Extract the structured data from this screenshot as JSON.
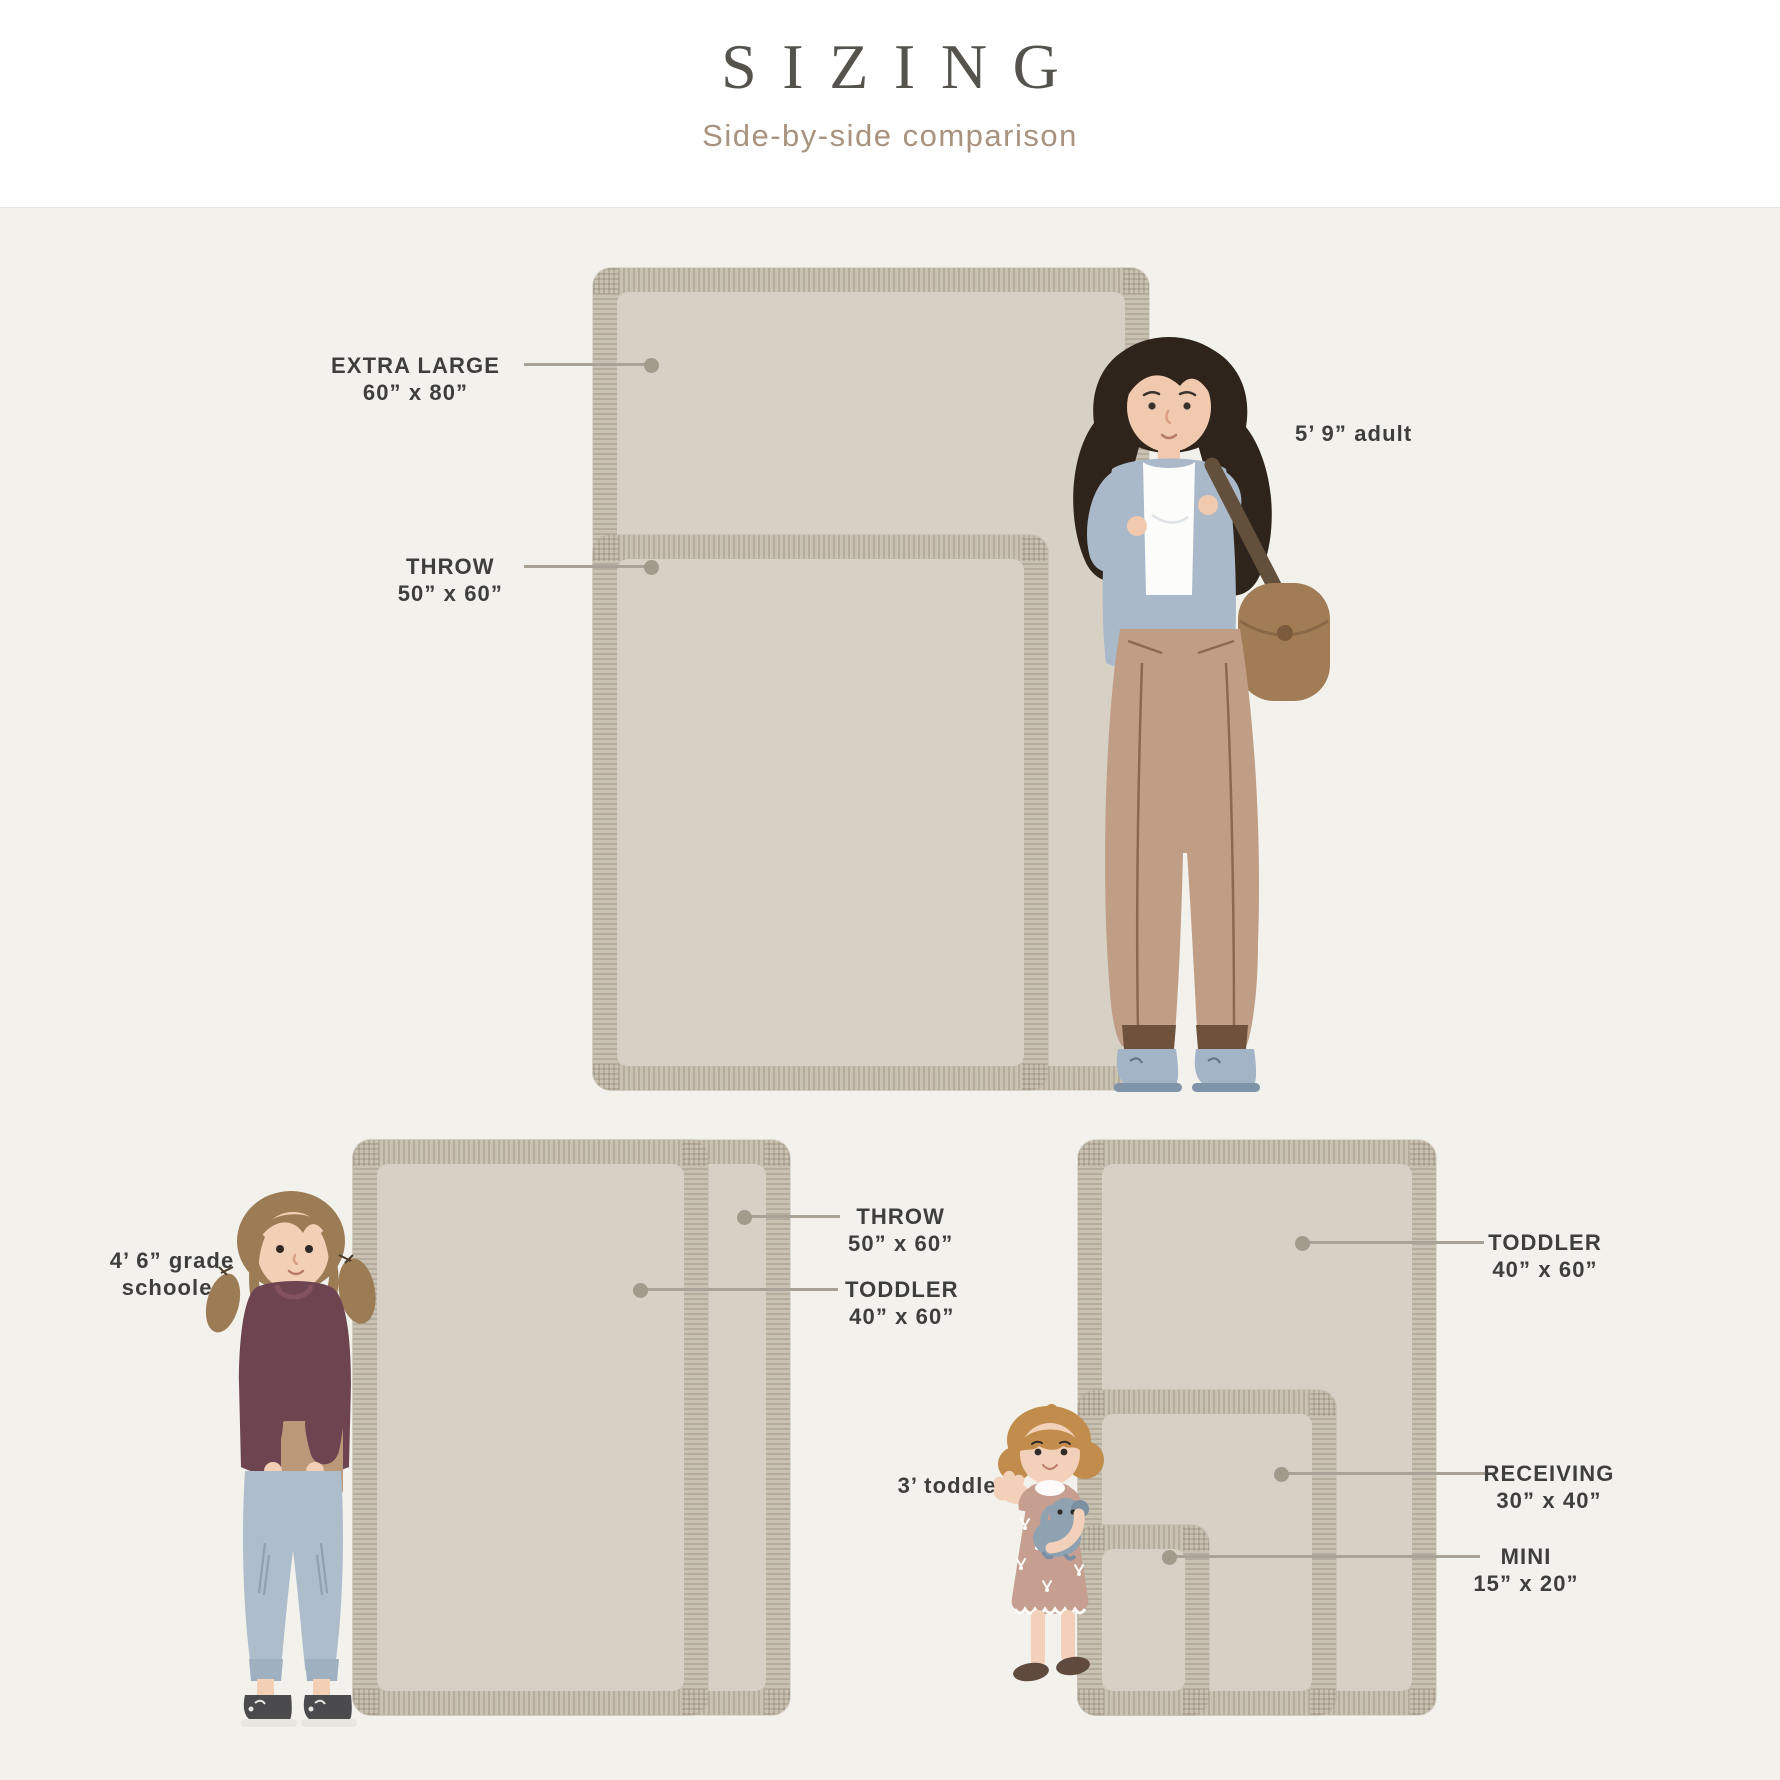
{
  "header": {
    "title": "SIZING",
    "subtitle": "Side-by-side comparison"
  },
  "palette": {
    "background": "#f2f1ec",
    "header_background": "#ffffff",
    "blanket_fringe": "#c9c1b2",
    "blanket_surface": "#d6d0c5",
    "leader_line": "#a9a296",
    "leader_dot": "#a29b8c",
    "label_text": "#3e3e3b",
    "title_text": "#55534e",
    "subtitle_text": "#a8937e"
  },
  "diagram": {
    "canvas": {
      "width": 1780,
      "height": 1780
    },
    "blankets": [
      {
        "id": "extra-large-top",
        "label": "EXTRA LARGE",
        "dimensions": "60” x 80”",
        "rect": {
          "x": 593,
          "y": 268,
          "w": 556,
          "h": 822
        }
      },
      {
        "id": "throw-top",
        "label": "THROW",
        "dimensions": "50” x 60”",
        "rect": {
          "x": 593,
          "y": 535,
          "w": 455,
          "h": 555
        }
      },
      {
        "id": "throw-bottom-left",
        "label": "THROW",
        "dimensions": "50” x 60”",
        "rect": {
          "x": 353,
          "y": 1140,
          "w": 437,
          "h": 575
        }
      },
      {
        "id": "toddler-bottom-left",
        "label": "TODDLER",
        "dimensions": "40” x 60”",
        "rect": {
          "x": 353,
          "y": 1140,
          "w": 355,
          "h": 575
        }
      },
      {
        "id": "toddler-bottom-right",
        "label": "TODDLER",
        "dimensions": "40” x 60”",
        "rect": {
          "x": 1078,
          "y": 1140,
          "w": 358,
          "h": 575
        }
      },
      {
        "id": "receiving",
        "label": "RECEIVING",
        "dimensions": "30” x 40”",
        "rect": {
          "x": 1078,
          "y": 1390,
          "w": 258,
          "h": 325
        }
      },
      {
        "id": "mini",
        "label": "MINI",
        "dimensions": "15” x 20”",
        "rect": {
          "x": 1078,
          "y": 1525,
          "w": 131,
          "h": 190
        }
      }
    ],
    "callouts": [
      {
        "id": "extra-large",
        "lines": [
          "EXTRA LARGE",
          "60” x 80”"
        ],
        "anchor": "right",
        "x": 500,
        "y": 352,
        "line": {
          "x1": 524,
          "x2": 651,
          "y": 364
        },
        "dot": {
          "x": 651,
          "y": 365
        }
      },
      {
        "id": "throw-top",
        "lines": [
          "THROW",
          "50” x 60”"
        ],
        "anchor": "right",
        "x": 503,
        "y": 553,
        "line": {
          "x1": 524,
          "x2": 651,
          "y": 566
        },
        "dot": {
          "x": 651,
          "y": 567
        }
      },
      {
        "id": "adult-height",
        "lines": [
          "5’ 9” adult"
        ],
        "anchor": "left",
        "x": 1295,
        "y": 420
      },
      {
        "id": "throw-bottom-left",
        "lines": [
          "THROW",
          "50” x 60”"
        ],
        "anchor": "left",
        "x": 848,
        "y": 1203,
        "line": {
          "x1": 744,
          "x2": 840,
          "y": 1216
        },
        "dot": {
          "x": 744,
          "y": 1217
        }
      },
      {
        "id": "toddler-bottom-left",
        "lines": [
          "TODDLER",
          "40” x 60”"
        ],
        "anchor": "left",
        "x": 845,
        "y": 1276,
        "line": {
          "x1": 640,
          "x2": 838,
          "y": 1289
        },
        "dot": {
          "x": 640,
          "y": 1290
        }
      },
      {
        "id": "grade-schooler-height",
        "lines": [
          "4’ 6” grade",
          "schooler"
        ],
        "anchor": "center",
        "x": 172,
        "y": 1247
      },
      {
        "id": "toddler-bottom-right",
        "lines": [
          "TODDLER",
          "40” x 60”"
        ],
        "anchor": "center",
        "x": 1545,
        "y": 1229,
        "line": {
          "x1": 1302,
          "x2": 1484,
          "y": 1242
        },
        "dot": {
          "x": 1302,
          "y": 1243
        }
      },
      {
        "id": "receiving",
        "lines": [
          "RECEIVING",
          "30” x 40”"
        ],
        "anchor": "center",
        "x": 1549,
        "y": 1460,
        "line": {
          "x1": 1281,
          "x2": 1486,
          "y": 1473
        },
        "dot": {
          "x": 1281,
          "y": 1474
        }
      },
      {
        "id": "mini",
        "lines": [
          "MINI",
          "15” x 20”"
        ],
        "anchor": "center",
        "x": 1526,
        "y": 1543,
        "line": {
          "x1": 1169,
          "x2": 1480,
          "y": 1556
        },
        "dot": {
          "x": 1169,
          "y": 1557
        }
      },
      {
        "id": "toddler-height",
        "lines": [
          "3’ toddler"
        ],
        "anchor": "center",
        "x": 952,
        "y": 1472
      }
    ],
    "figures": [
      {
        "id": "adult",
        "description": "5’ 9” adult"
      },
      {
        "id": "grade-schooler",
        "description": "4’ 6” grade schooler"
      },
      {
        "id": "toddler",
        "description": "3’ toddler"
      }
    ]
  }
}
